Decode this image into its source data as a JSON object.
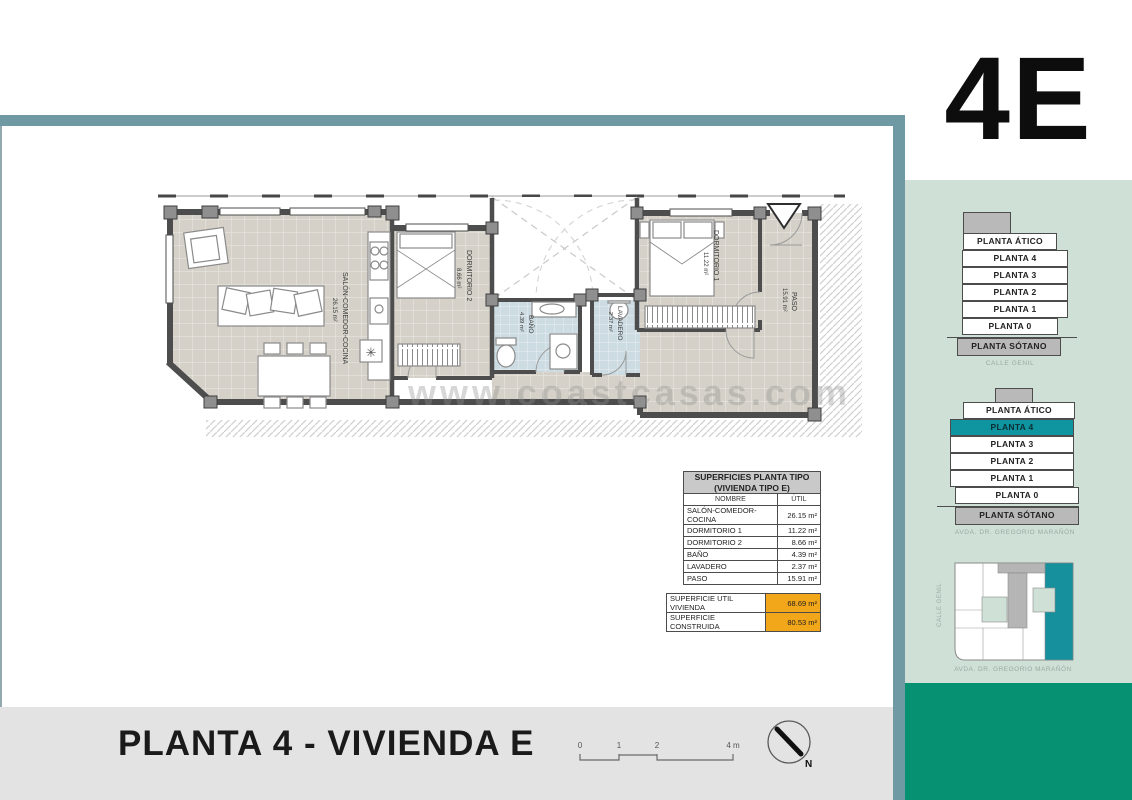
{
  "page": {
    "unit_code": "4E",
    "title": "PLANTA 4 - VIVIENDA E",
    "watermark": "www.coastcasas.com"
  },
  "plan": {
    "rooms": [
      {
        "name": "SALÓN-COMEDOR-COCINA",
        "area": "26.15 m²"
      },
      {
        "name": "DORMITORIO 1",
        "area": "11.22 m²"
      },
      {
        "name": "DORMITORIO 2",
        "area": "8.66 m²"
      },
      {
        "name": "BAÑO",
        "area": "4.39 m²"
      },
      {
        "name": "LAVADERO",
        "area": "2.37 m²"
      },
      {
        "name": "PASO",
        "area": "15.91 m²"
      }
    ]
  },
  "table": {
    "title_line1": "SUPERFICIES PLANTA TIPO",
    "title_line2": "(VIVIENDA TIPO E)",
    "col_name": "NOMBRE",
    "col_util": "ÚTIL",
    "rows": [
      {
        "name": "SALÓN-COMEDOR-COCINA",
        "util": "26.15 m²"
      },
      {
        "name": "DORMITORIO 1",
        "util": "11.22 m²"
      },
      {
        "name": "DORMITORIO 2",
        "util": "8.66 m²"
      },
      {
        "name": "BAÑO",
        "util": "4.39 m²"
      },
      {
        "name": "LAVADERO",
        "util": "2.37 m²"
      },
      {
        "name": "PASO",
        "util": "15.91 m²"
      }
    ],
    "summary": [
      {
        "label": "SUPERFICIE UTIL VIVIENDA",
        "value": "68.69 m²"
      },
      {
        "label": "SUPERFICIE CONSTRUIDA",
        "value": "80.53 m²"
      }
    ]
  },
  "sidebar": {
    "elevation_front": {
      "floors": [
        "PLANTA ÁTICO",
        "PLANTA 4",
        "PLANTA 3",
        "PLANTA 2",
        "PLANTA 1",
        "PLANTA 0",
        "PLANTA SÓTANO"
      ],
      "street": "CALLE GENIL"
    },
    "elevation_side": {
      "floors": [
        "PLANTA ÁTICO",
        "PLANTA 4",
        "PLANTA 3",
        "PLANTA 2",
        "PLANTA 1",
        "PLANTA 0",
        "PLANTA SÓTANO"
      ],
      "highlighted_floor": "PLANTA 4",
      "street": "AVDA. DR. GREGORIO MARAÑÓN"
    },
    "siteplan": {
      "street_left": "CALLE GENIL",
      "street_bottom": "AVDA. DR. GREGORIO MARAÑÓN"
    }
  },
  "scalebar": {
    "t0": "0",
    "t1": "1",
    "t2": "2",
    "t4": "4 m"
  },
  "north_label": "N",
  "colors": {
    "accent_teal_border": "#6f99a3",
    "sidebar_mint": "#cfe0d6",
    "brand_green": "#069173",
    "highlight_teal": "#0e95a0",
    "summary_orange": "#f2a71b"
  }
}
